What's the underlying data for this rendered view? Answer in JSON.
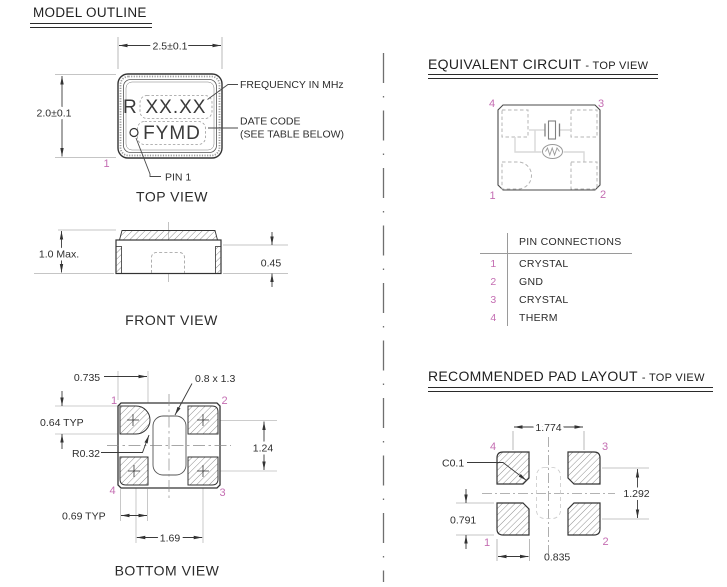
{
  "colors": {
    "pin_number": "#c46db2",
    "drawing_line": "#333333",
    "light_line": "#999999",
    "circuit_wire": "#d9d9d9",
    "background": "#ffffff"
  },
  "model_outline": {
    "title": "MODEL OUTLINE",
    "top_view": {
      "caption": "TOP VIEW",
      "dim_width": "2.5±0.1",
      "dim_height": "2.0±0.1",
      "marking_prefix": "R",
      "marking_frequency": "XX.XX",
      "marking_datecode": "FYMD",
      "callout_frequency": "FREQUENCY IN MHz",
      "callout_datecode_line1": "DATE CODE",
      "callout_datecode_line2": "(SEE TABLE BELOW)",
      "callout_pin1": "PIN 1",
      "pin1": "1"
    },
    "front_view": {
      "caption": "FRONT VIEW",
      "dim_height_max": "1.0 Max.",
      "dim_castellation": "0.45"
    },
    "bottom_view": {
      "caption": "BOTTOM VIEW",
      "dim_pad1_width": "0.735",
      "dim_center_slot": "0.8 x 1.3",
      "dim_pad_height": "0.64 TYP",
      "dim_corner_radius": "R0.32",
      "dim_pad_row_pitch": "1.24",
      "dim_pad_width": "0.69 TYP",
      "dim_pad_col_pitch": "1.69",
      "pin1": "1",
      "pin2": "2",
      "pin3": "3",
      "pin4": "4"
    }
  },
  "equivalent_circuit": {
    "title": "EQUIVALENT CIRCUIT",
    "subtitle": "- TOP VIEW",
    "pin1": "1",
    "pin2": "2",
    "pin3": "3",
    "pin4": "4"
  },
  "pin_connections": {
    "header": "PIN CONNECTIONS",
    "rows": [
      {
        "pin": "1",
        "name": "CRYSTAL"
      },
      {
        "pin": "2",
        "name": "GND"
      },
      {
        "pin": "3",
        "name": "CRYSTAL"
      },
      {
        "pin": "4",
        "name": "THERM"
      }
    ]
  },
  "pad_layout": {
    "title": "RECOMMENDED PAD LAYOUT",
    "subtitle": "- TOP VIEW",
    "dim_pad_col_pitch": "1.774",
    "dim_chamfer": "C0.1",
    "dim_pad_row_pitch": "1.292",
    "dim_pad_height": "0.791",
    "dim_pad_width": "0.835",
    "pin1": "1",
    "pin2": "2",
    "pin3": "3",
    "pin4": "4"
  }
}
